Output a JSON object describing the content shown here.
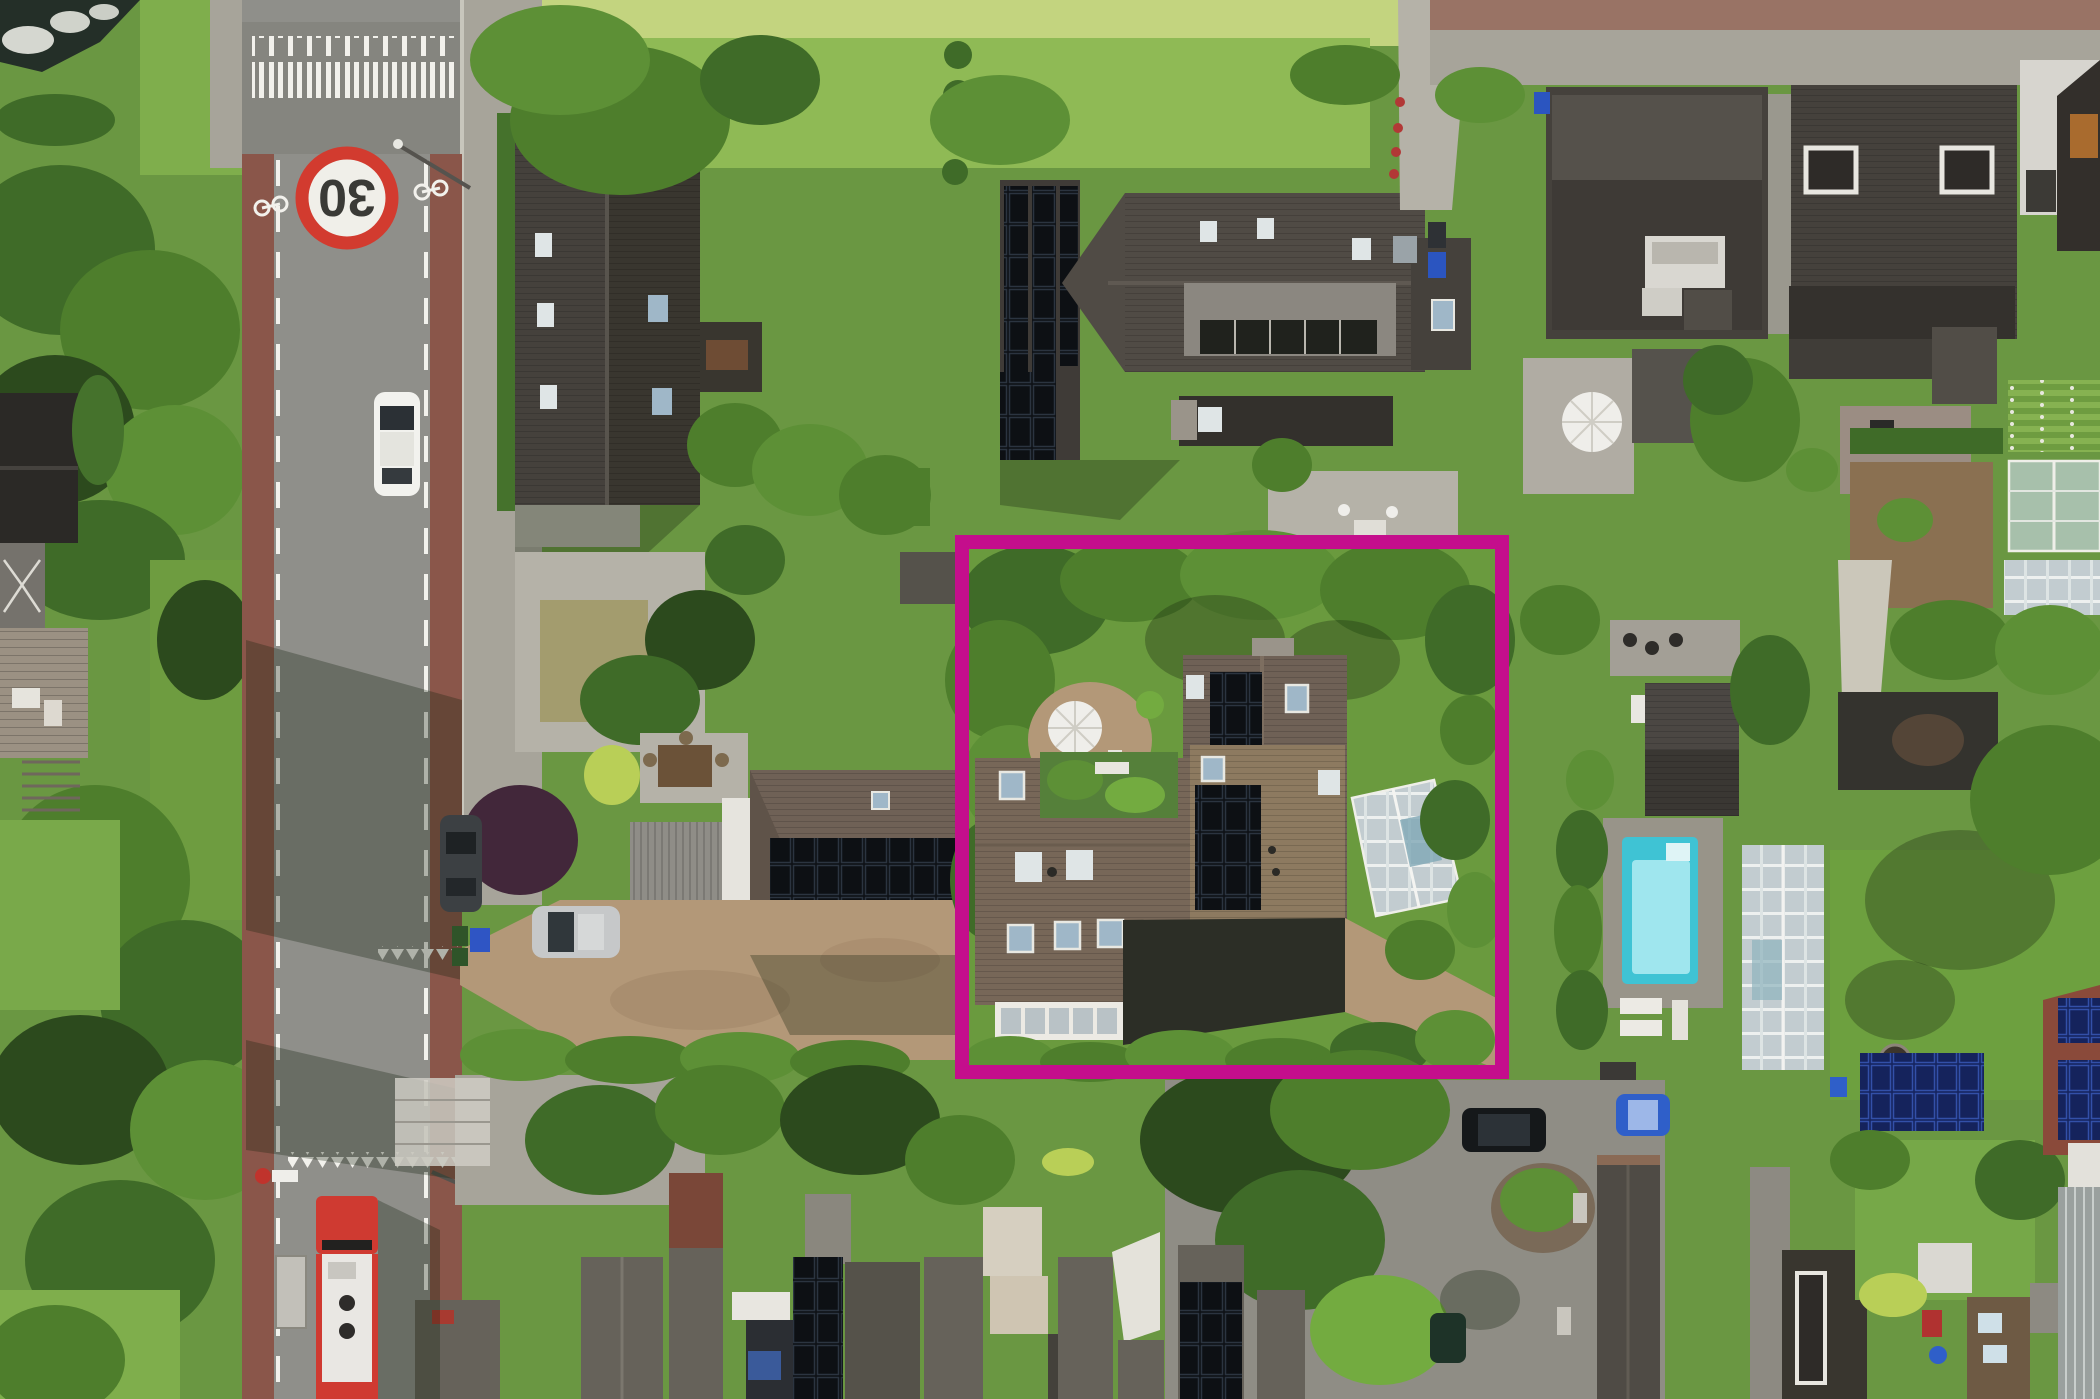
{
  "image": {
    "kind": "aerial-drone-photo",
    "description": "Top-down drone photo of a Dutch residential street with gardens, solar-panelled roofs, a swimming pool and a bus; one property is outlined with a magenta rectangle",
    "width_px": 2100,
    "height_px": 1399
  },
  "environment": {
    "grass_color": "#6a9742",
    "field_color": "#c3d47f",
    "water_color": "#242f28"
  },
  "highlight": {
    "shape": "rectangle",
    "color": "#c40e8c",
    "x": 962,
    "y": 542,
    "width": 540,
    "height": 530,
    "stroke_px": 14
  },
  "road": {
    "speed_limit_marking": "30",
    "sign_ring_color": "#d23b2f",
    "sign_face_color": "#f0efe9",
    "sign_text_color": "#3a3a36",
    "asphalt_color": "#8f8f8a",
    "crossing_zone_color": "#85857f",
    "bike_lane_color": "#8a564a",
    "lane_marking_color": "#f2f1ec"
  },
  "vehicles": {
    "white_car_color": "#f2f2ee",
    "silver_car_color": "#c6c8c9",
    "black_parked_car_color": "#3c4043",
    "black_suv_color": "#15181a",
    "blue_car_color": "#2f5fc9",
    "dark_green_car_color": "#1e3328",
    "bus": {
      "front_color": "#cf3a31",
      "body_color": "#e9e7e3"
    }
  },
  "features": {
    "pool_color": "#3fc3d4",
    "pool_inner_color": "#9fe6ee",
    "parasol_color": "#efeeea",
    "parasol_count": 2,
    "solar_panel_color": "#0d1014",
    "blue_solar_color": "#15235c",
    "greenhouse_glass_color": "#adc3b4",
    "houses_with_solar": 7
  }
}
